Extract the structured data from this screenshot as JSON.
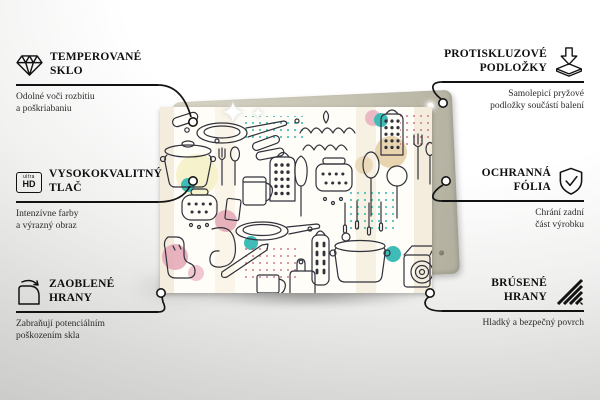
{
  "callouts": {
    "left": [
      {
        "icon": "diamond-icon",
        "title_line1": "TEMPEROVANÉ",
        "title_line2": "SKLO",
        "subtitle_line1": "Odolné voči rozbitiu",
        "subtitle_line2": "a poškriabaniu"
      },
      {
        "icon": "ultra-hd-icon",
        "icon_label_top": "ultra",
        "icon_label_bottom": "HD",
        "title_line1": "VYSOKOKVALITNÝ",
        "title_line2": "TLAČ",
        "subtitle_line1": "Intenzívne farby",
        "subtitle_line2": "a výrazný obraz"
      },
      {
        "icon": "rounded-corner-icon",
        "title_line1": "ZAOBLENÉ",
        "title_line2": "HRANY",
        "subtitle_line1": "Zabraňují potenciálním",
        "subtitle_line2": "poškozením skla"
      }
    ],
    "right": [
      {
        "icon": "anti-slip-pads-icon",
        "title_line1": "PROTISKLUZOVÉ",
        "title_line2": "PODLOŽKY",
        "subtitle_line1": "Samolepicí pryžové",
        "subtitle_line2": "podložky součástí balení"
      },
      {
        "icon": "shield-check-icon",
        "title_line1": "OCHRANNÁ",
        "title_line2": "FÓLIA",
        "subtitle_line1": "Chrání zadní",
        "subtitle_line2": "část výrobku"
      },
      {
        "icon": "polished-edges-icon",
        "title_line1": "BRÚSENÉ",
        "title_line2": "HRANY",
        "subtitle_line1": "Hladký a bezpečný povrch",
        "subtitle_line2": ""
      }
    ]
  },
  "colors": {
    "line": "#151515",
    "glass_background": "#fffdf7",
    "backing_pad": "#c6c3b3",
    "accent_teal": "#3fbcb6",
    "accent_pink": "#e9afbe",
    "accent_yellow": "#f6f2cc",
    "accent_tan": "#e2cb9e",
    "accent_red_dots": "#c25b6e",
    "doodle_line": "#31313b"
  }
}
